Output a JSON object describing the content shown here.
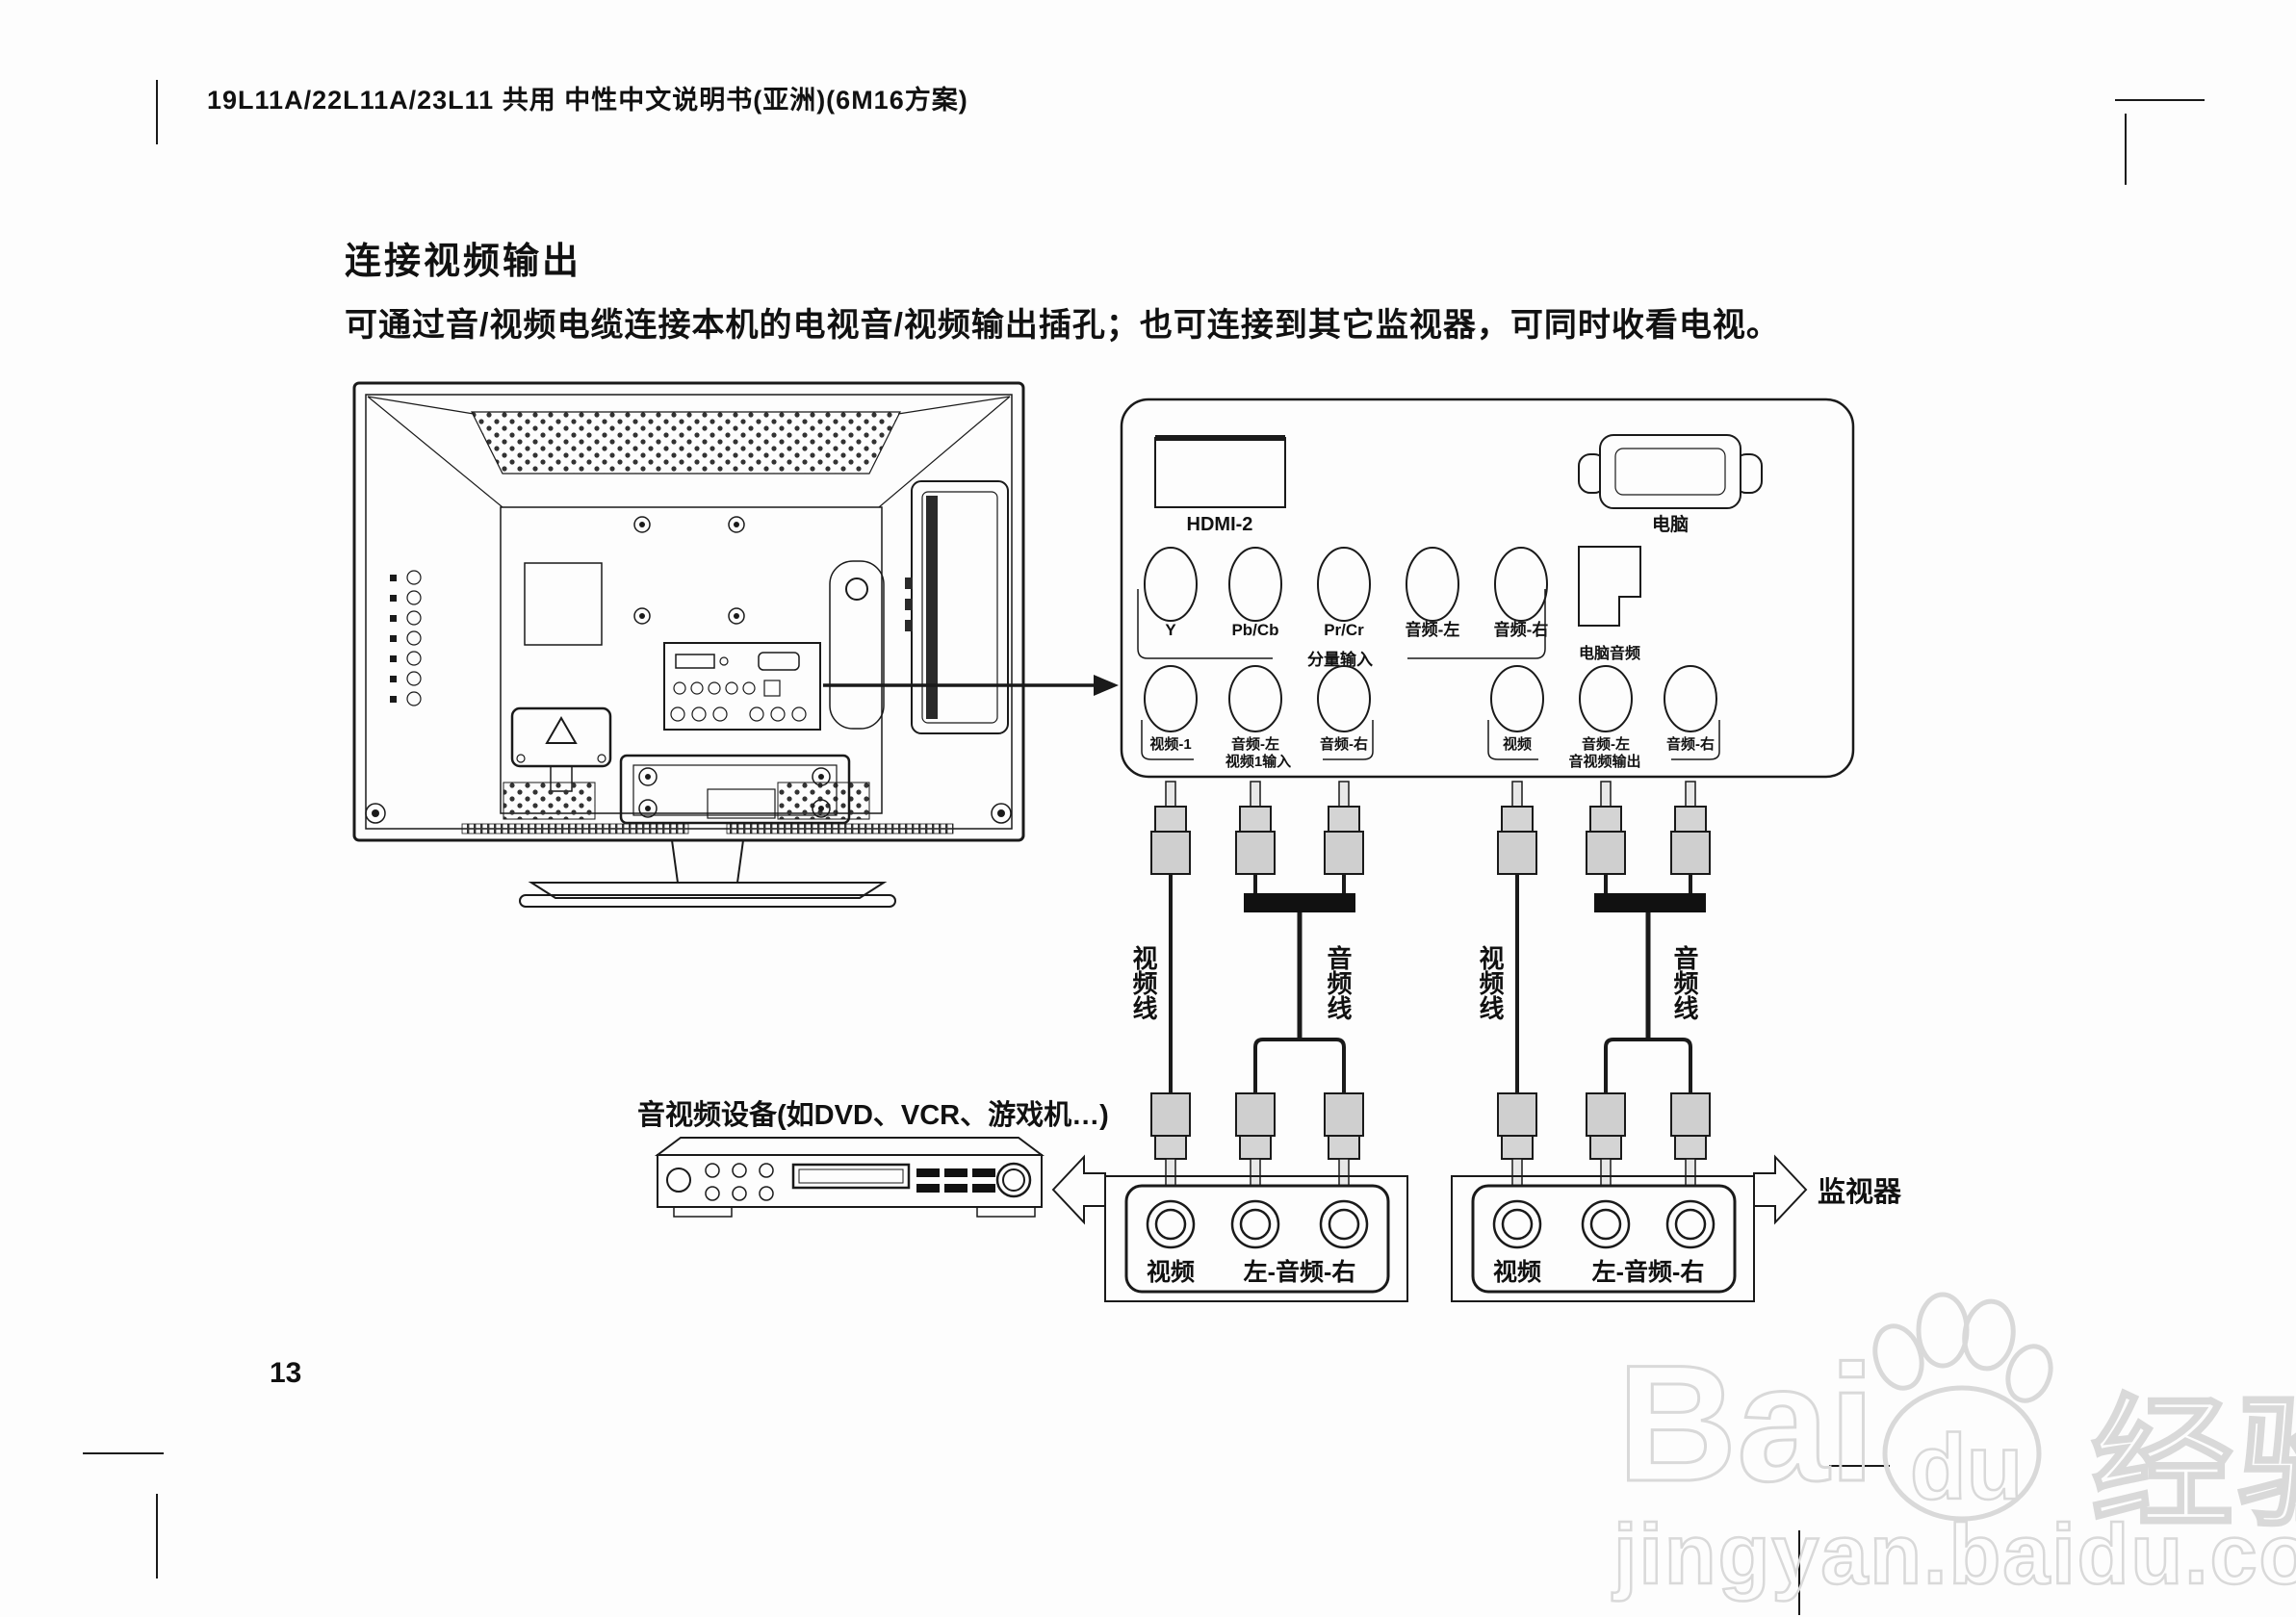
{
  "page": {
    "header": "19L11A/22L11A/23L11 共用 中性中文说明书(亚洲)(6M16方案)",
    "section_title": "连接视频输出",
    "body_text": "可通过音/视频电缆连接本机的电视音/视频输出插孔；也可连接到其它监视器，可同时收看电视。",
    "page_number": "13"
  },
  "panel": {
    "hdmi_label": "HDMI-2",
    "pc_label": "电脑",
    "pc_audio_label": "电脑音频",
    "component_group_label": "分量输入",
    "row1_jacks": [
      "Y",
      "Pb/Cb",
      "Pr/Cr",
      "音频-左",
      "音频-右"
    ],
    "row2_left_jacks": [
      "视频-1",
      "音频-左",
      "音频-右"
    ],
    "row2_left_group_label": "视频1输入",
    "row2_right_jacks": [
      "视频",
      "音频-左",
      "音频-右"
    ],
    "row2_right_group_label": "音视频输出"
  },
  "cables": {
    "video": "视频线",
    "audio": "音频线"
  },
  "bottom": {
    "av_device": "音视频设备(如DVD、VCR、游戏机…)",
    "monitor": "监视器",
    "box_video": "视频",
    "box_audio": "左-音频-右"
  },
  "watermark": {
    "brand_left": "Bai",
    "brand_mid": "du",
    "brand_right": "经验",
    "url": "jingyan.baidu.com"
  },
  "colors": {
    "line": "#1a1a1a",
    "watermark": "#d9d9d9"
  }
}
